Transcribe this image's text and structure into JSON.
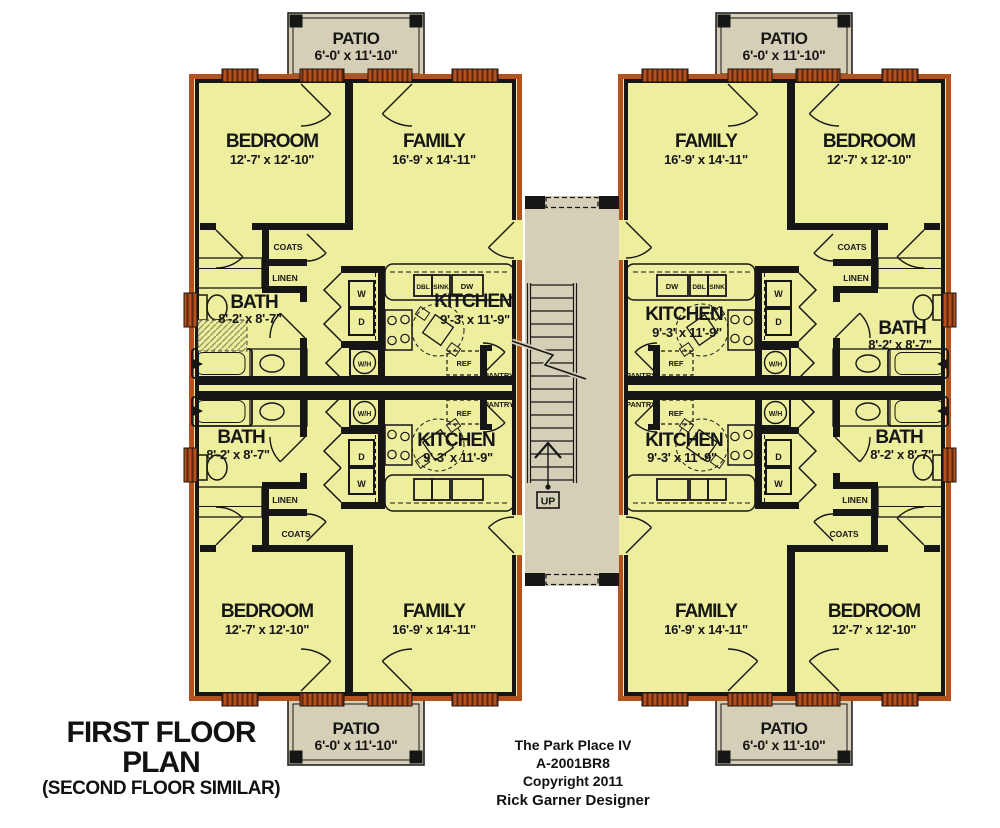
{
  "title": {
    "main": "FIRST FLOOR PLAN",
    "sub": "(SECOND FLOOR SIMILAR)"
  },
  "footer": {
    "line1": "The Park Place IV",
    "line2": "A-2001BR8",
    "line3": "Copyright 2011",
    "line4": "Rick Garner Designer"
  },
  "colors": {
    "room": "#edef9f",
    "wall_brick": "#b3511f",
    "wall_brick_dark": "#5e250c",
    "wall_black": "#161616",
    "patio": "#d4cfb6",
    "background": "#ffffff"
  },
  "plan_labels": [
    {
      "n": "room-label-bedroom-ul",
      "t": "BEDROOM",
      "x": 272,
      "y": 147,
      "s": 19,
      "ls": -1
    },
    {
      "n": "room-dims-bedroom-ul",
      "t": "12'-7' x 12'-10\"",
      "x": 272,
      "y": 164,
      "s": 13,
      "ls": -0.3
    },
    {
      "n": "room-label-family-ul",
      "t": "FAMILY",
      "x": 434,
      "y": 147,
      "s": 19,
      "ls": -1
    },
    {
      "n": "room-dims-family-ul",
      "t": "16'-9' x 14'-11\"",
      "x": 434,
      "y": 164,
      "s": 13,
      "ls": -0.3
    },
    {
      "n": "closet-label-coats-ul",
      "t": "COATS",
      "x": 288,
      "y": 250,
      "s": 8.5
    },
    {
      "n": "closet-label-linen-ul",
      "t": "LINEN",
      "x": 285,
      "y": 281,
      "s": 8.5
    },
    {
      "n": "room-label-bath-ul",
      "t": "BATH",
      "x": 254,
      "y": 308,
      "s": 19,
      "ls": -1
    },
    {
      "n": "room-dims-bath-ul",
      "t": "8'-2' x 8'-7\"",
      "x": 250,
      "y": 323,
      "s": 13,
      "ls": -0.3
    },
    {
      "n": "appliance-label-washer-ul",
      "t": "W",
      "x": 361.5,
      "y": 297,
      "s": 9
    },
    {
      "n": "appliance-label-dryer-ul",
      "t": "D",
      "x": 361.5,
      "y": 325,
      "s": 9
    },
    {
      "n": "appliance-label-waterheater-ul",
      "t": "W/H",
      "x": 364.5,
      "y": 366.5,
      "s": 7
    },
    {
      "n": "room-label-kitchen-ul",
      "t": "KITCHEN",
      "x": 473,
      "y": 307,
      "s": 19,
      "ls": -1
    },
    {
      "n": "room-dims-kitchen-ul",
      "t": "9'-3' x 11'-9\"",
      "x": 475,
      "y": 324,
      "s": 13,
      "ls": -0.3
    },
    {
      "n": "appliance-label-dbl-ul",
      "t": "DBL",
      "x": 423,
      "y": 289,
      "s": 6.5
    },
    {
      "n": "appliance-label-sink-ul",
      "t": "SINK",
      "x": 441,
      "y": 289,
      "s": 6.5
    },
    {
      "n": "appliance-label-dw-ul",
      "t": "DW",
      "x": 467,
      "y": 289,
      "s": 7.5
    },
    {
      "n": "appliance-label-ref-ul",
      "t": "REF",
      "x": 464,
      "y": 366,
      "s": 7.5
    },
    {
      "n": "closet-label-pantry-ul",
      "t": "PANTRY",
      "x": 499,
      "y": 378,
      "s": 7.5
    },
    {
      "n": "closet-label-pantry-ll",
      "t": "PANTRY",
      "x": 499,
      "y": 407,
      "s": 7.5
    },
    {
      "n": "appliance-label-ref-ll",
      "t": "REF",
      "x": 464,
      "y": 416,
      "s": 7.5
    },
    {
      "n": "appliance-label-waterheater-ll",
      "t": "W/H",
      "x": 364.5,
      "y": 416,
      "s": 7
    },
    {
      "n": "appliance-label-dryer-ll",
      "t": "D",
      "x": 361.5,
      "y": 460,
      "s": 9
    },
    {
      "n": "appliance-label-washer-ll",
      "t": "W",
      "x": 361.5,
      "y": 487,
      "s": 9
    },
    {
      "n": "room-label-kitchen-ll",
      "t": "KITCHEN",
      "x": 456,
      "y": 446,
      "s": 19,
      "ls": -1
    },
    {
      "n": "room-dims-kitchen-ll",
      "t": "9'-3' x 11'-9\"",
      "x": 458,
      "y": 462,
      "s": 13,
      "ls": -0.3
    },
    {
      "n": "room-label-bath-ll",
      "t": "BATH",
      "x": 241,
      "y": 443,
      "s": 19,
      "ls": -1
    },
    {
      "n": "room-dims-bath-ll",
      "t": "8'-2' x 8'-7\"",
      "x": 238,
      "y": 459,
      "s": 13,
      "ls": -0.3
    },
    {
      "n": "closet-label-linen-ll",
      "t": "LINEN",
      "x": 285,
      "y": 503,
      "s": 8.5
    },
    {
      "n": "closet-label-coats-ll",
      "t": "COATS",
      "x": 296,
      "y": 537,
      "s": 8.5
    },
    {
      "n": "room-label-bedroom-ll",
      "t": "BEDROOM",
      "x": 267,
      "y": 617,
      "s": 19,
      "ls": -1
    },
    {
      "n": "room-dims-bedroom-ll",
      "t": "12'-7' x 12'-10\"",
      "x": 267,
      "y": 634,
      "s": 13,
      "ls": -0.3
    },
    {
      "n": "room-label-family-ll",
      "t": "FAMILY",
      "x": 434,
      "y": 617,
      "s": 19,
      "ls": -1
    },
    {
      "n": "room-dims-family-ll",
      "t": "16'-9' x 14'-11\"",
      "x": 434,
      "y": 634,
      "s": 13,
      "ls": -0.3
    },
    {
      "n": "room-label-family-ur",
      "t": "FAMILY",
      "x": 706,
      "y": 147,
      "s": 19,
      "ls": -1
    },
    {
      "n": "room-dims-family-ur",
      "t": "16'-9' x 14'-11\"",
      "x": 706,
      "y": 164,
      "s": 13,
      "ls": -0.3
    },
    {
      "n": "room-label-bedroom-ur",
      "t": "BEDROOM",
      "x": 869,
      "y": 147,
      "s": 19,
      "ls": -1
    },
    {
      "n": "room-dims-bedroom-ur",
      "t": "12'-7' x 12'-10\"",
      "x": 869,
      "y": 164,
      "s": 13,
      "ls": -0.3
    },
    {
      "n": "closet-label-coats-ur",
      "t": "COATS",
      "x": 852,
      "y": 250,
      "s": 8.5
    },
    {
      "n": "closet-label-linen-ur",
      "t": "LINEN",
      "x": 856,
      "y": 281,
      "s": 8.5
    },
    {
      "n": "room-label-bath-ur",
      "t": "BATH",
      "x": 902,
      "y": 334,
      "s": 19,
      "ls": -1
    },
    {
      "n": "room-dims-bath-ur",
      "t": "8'-2' x 8'-7\"",
      "x": 900,
      "y": 349,
      "s": 13,
      "ls": -0.3
    },
    {
      "n": "appliance-label-washer-ur",
      "t": "W",
      "x": 778.5,
      "y": 297,
      "s": 9
    },
    {
      "n": "appliance-label-dryer-ur",
      "t": "D",
      "x": 778.5,
      "y": 325,
      "s": 9
    },
    {
      "n": "appliance-label-waterheater-ur",
      "t": "W/H",
      "x": 775.5,
      "y": 366.5,
      "s": 7
    },
    {
      "n": "room-label-kitchen-ur",
      "t": "KITCHEN",
      "x": 684,
      "y": 320,
      "s": 19,
      "ls": -1
    },
    {
      "n": "room-dims-kitchen-ur",
      "t": "9'-3' x 11'-9\"",
      "x": 687,
      "y": 337,
      "s": 13,
      "ls": -0.3
    },
    {
      "n": "appliance-label-dw-ur",
      "t": "DW",
      "x": 672,
      "y": 289,
      "s": 7.5
    },
    {
      "n": "appliance-label-dbl-ur",
      "t": "DBL",
      "x": 699,
      "y": 289,
      "s": 6.5
    },
    {
      "n": "appliance-label-sink-ur",
      "t": "SINK",
      "x": 717,
      "y": 289,
      "s": 6.5
    },
    {
      "n": "appliance-label-ref-ur",
      "t": "REF",
      "x": 676,
      "y": 366,
      "s": 7.5
    },
    {
      "n": "closet-label-pantry-ur",
      "t": "PANTRY",
      "x": 641,
      "y": 378,
      "s": 7.5
    },
    {
      "n": "closet-label-pantry-lr",
      "t": "PANTRY",
      "x": 641,
      "y": 407,
      "s": 7.5
    },
    {
      "n": "appliance-label-ref-lr",
      "t": "REF",
      "x": 676,
      "y": 416,
      "s": 7.5
    },
    {
      "n": "appliance-label-waterheater-lr",
      "t": "W/H",
      "x": 775.5,
      "y": 416,
      "s": 7
    },
    {
      "n": "appliance-label-dryer-lr",
      "t": "D",
      "x": 778.5,
      "y": 460,
      "s": 9
    },
    {
      "n": "appliance-label-washer-lr",
      "t": "W",
      "x": 778.5,
      "y": 487,
      "s": 9
    },
    {
      "n": "room-label-kitchen-lr",
      "t": "KITCHEN",
      "x": 684,
      "y": 446,
      "s": 19,
      "ls": -1
    },
    {
      "n": "room-dims-kitchen-lr",
      "t": "9'-3' x 11'-9\"",
      "x": 682,
      "y": 462,
      "s": 13,
      "ls": -0.3
    },
    {
      "n": "room-label-bath-lr",
      "t": "BATH",
      "x": 899,
      "y": 443,
      "s": 19,
      "ls": -1
    },
    {
      "n": "room-dims-bath-lr",
      "t": "8'-2' x 8'-7\"",
      "x": 902,
      "y": 459,
      "s": 13,
      "ls": -0.3
    },
    {
      "n": "closet-label-linen-lr",
      "t": "LINEN",
      "x": 855,
      "y": 503,
      "s": 8.5
    },
    {
      "n": "closet-label-coats-lr",
      "t": "COATS",
      "x": 844,
      "y": 537,
      "s": 8.5
    },
    {
      "n": "room-label-family-lr",
      "t": "FAMILY",
      "x": 706,
      "y": 617,
      "s": 19,
      "ls": -1
    },
    {
      "n": "room-dims-family-lr",
      "t": "16'-9' x 14'-11\"",
      "x": 706,
      "y": 634,
      "s": 13,
      "ls": -0.3
    },
    {
      "n": "room-label-bedroom-lr",
      "t": "BEDROOM",
      "x": 874,
      "y": 617,
      "s": 19,
      "ls": -1
    },
    {
      "n": "room-dims-bedroom-lr",
      "t": "12'-7' x 12'-10\"",
      "x": 874,
      "y": 634,
      "s": 13,
      "ls": -0.3
    },
    {
      "n": "patio-label-top-left",
      "t": "PATIO",
      "x": 356,
      "y": 44,
      "s": 17,
      "ls": -0.5
    },
    {
      "n": "patio-dims-top-left",
      "t": "6'-0' x 11'-10\"",
      "x": 356,
      "y": 60,
      "s": 14,
      "ls": -0.3
    },
    {
      "n": "patio-label-top-right",
      "t": "PATIO",
      "x": 784,
      "y": 44,
      "s": 17,
      "ls": -0.5
    },
    {
      "n": "patio-dims-top-right",
      "t": "6'-0' x 11'-10\"",
      "x": 784,
      "y": 60,
      "s": 14,
      "ls": -0.3
    },
    {
      "n": "patio-label-bottom-left",
      "t": "PATIO",
      "x": 356,
      "y": 734,
      "s": 17,
      "ls": -0.5
    },
    {
      "n": "patio-dims-bottom-left",
      "t": "6'-0' x 11'-10\"",
      "x": 356,
      "y": 750,
      "s": 14,
      "ls": -0.3
    },
    {
      "n": "patio-label-bottom-right",
      "t": "PATIO",
      "x": 784,
      "y": 734,
      "s": 17,
      "ls": -0.5
    },
    {
      "n": "patio-dims-bottom-right",
      "t": "6'-0' x 11'-10\"",
      "x": 784,
      "y": 750,
      "s": 14,
      "ls": -0.3
    },
    {
      "n": "stair-up-label",
      "t": "UP",
      "x": 548,
      "y": 504.5,
      "s": 10.5
    }
  ]
}
